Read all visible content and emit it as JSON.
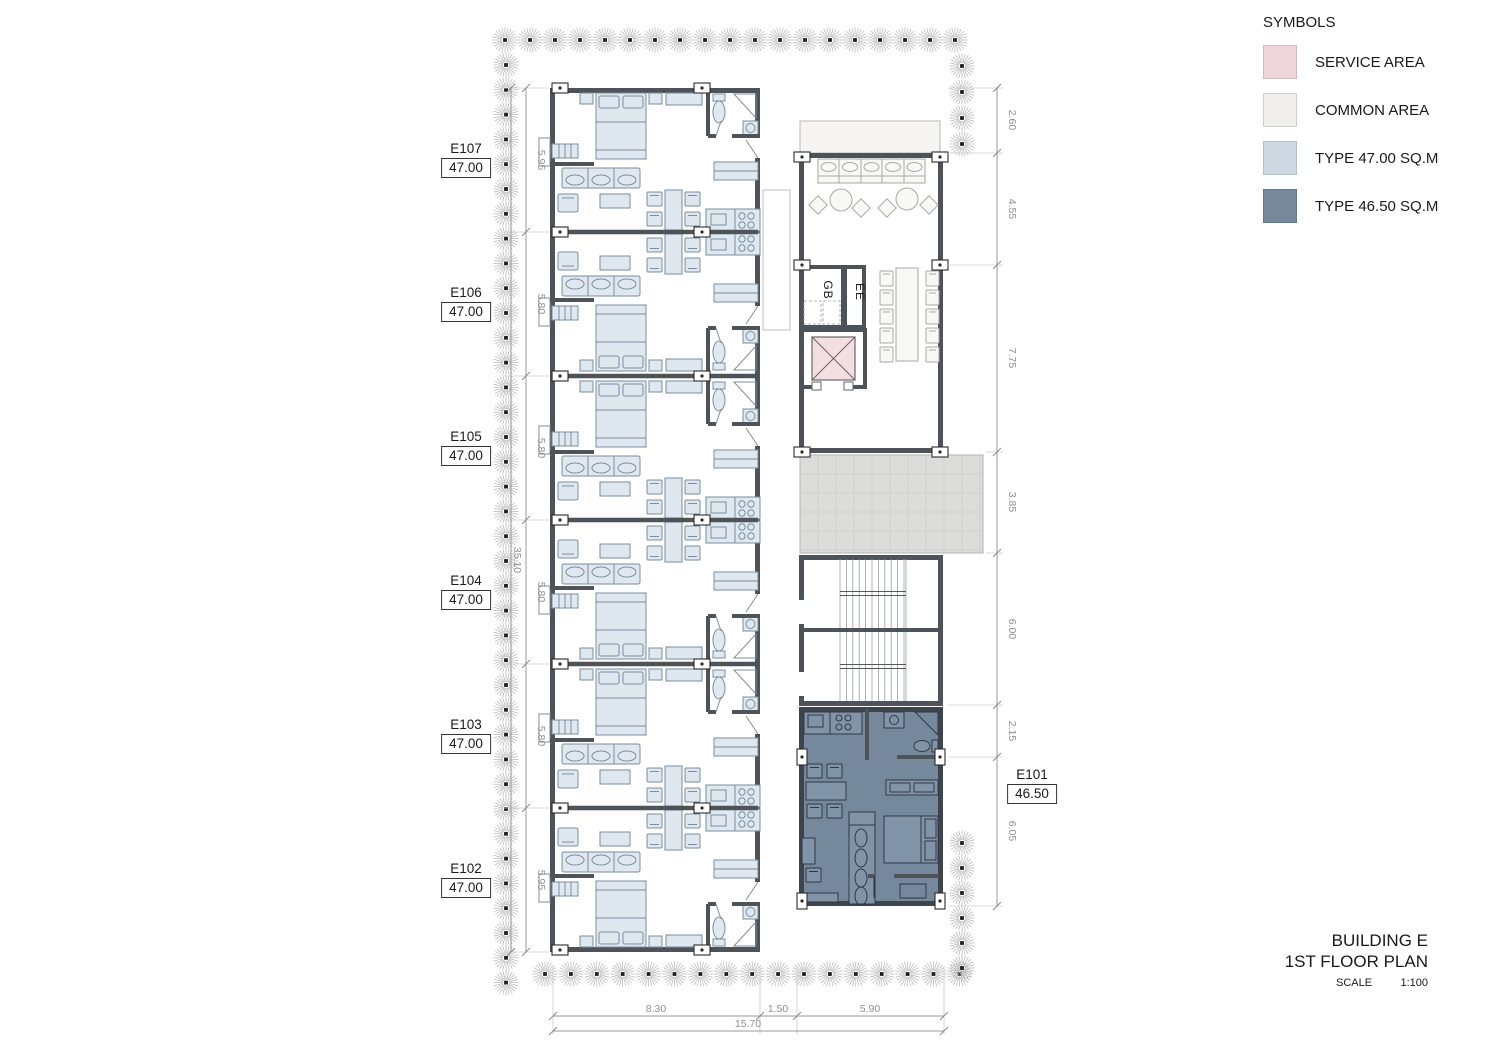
{
  "legend": {
    "title": "SYMBOLS",
    "items": [
      {
        "label": "SERVICE AREA",
        "color": "#eed5da"
      },
      {
        "label": "COMMON AREA",
        "color": "#efeeec"
      },
      {
        "label": "TYPE 47.00 SQ.M",
        "color": "#ccd9e3"
      },
      {
        "label": "TYPE 46.50 SQ.M",
        "color": "#76889b"
      }
    ]
  },
  "units": [
    {
      "id": "E107",
      "area": "47.00"
    },
    {
      "id": "E106",
      "area": "47.00"
    },
    {
      "id": "E105",
      "area": "47.00"
    },
    {
      "id": "E104",
      "area": "47.00"
    },
    {
      "id": "E103",
      "area": "47.00"
    },
    {
      "id": "E102",
      "area": "47.00"
    },
    {
      "id": "E101",
      "area": "46.50"
    }
  ],
  "rooms": {
    "gb": "GB",
    "ee": "EE"
  },
  "dimensions": {
    "left": [
      "5.95",
      "5.80",
      "5.80",
      "5.80",
      "5.80",
      "5.95"
    ],
    "left_total": "35.10",
    "right": [
      "2.60",
      "4.55",
      "7.75",
      "3.85",
      "6.00",
      "2.15",
      "6.05"
    ],
    "bottom": [
      "8.30",
      "1.50",
      "5.90"
    ],
    "bottom_total": "15.70"
  },
  "title_block": {
    "project": "BUILDING E",
    "drawing": "1ST FLOOR PLAN",
    "scale_label": "SCALE",
    "scale_value": "1:100"
  },
  "colors": {
    "service_area": "#eed7db",
    "common_area": "#edecea",
    "type_47": "#cdd9e3",
    "type_46": "#76889b",
    "wall": "#4d5359"
  }
}
